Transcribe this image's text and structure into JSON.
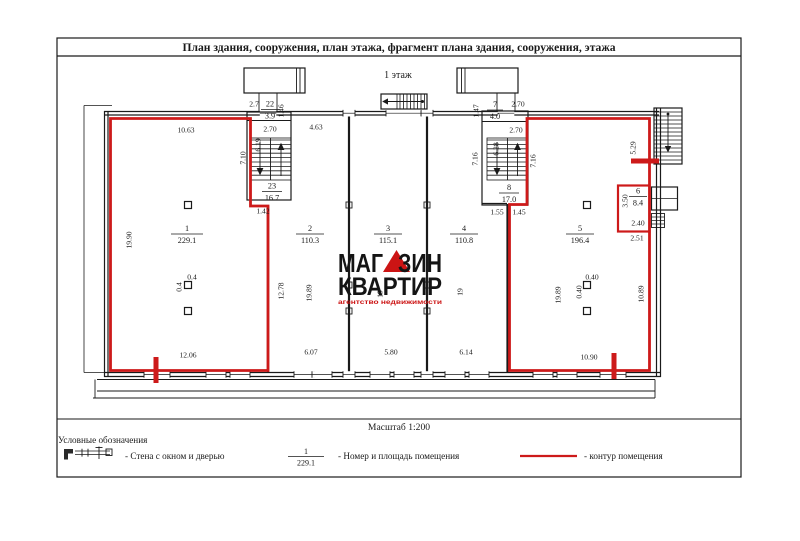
{
  "document": {
    "title": "План здания, сооружения, план этажа, фрагмент плана здания, сооружения, этажа",
    "floor_label": "1 этаж",
    "scale_label": "Масштаб 1:200"
  },
  "legend": {
    "heading": "Условные обозначения",
    "wall_item": "- Стена с окном и дверью",
    "number_item": "- Номер и площадь помещения",
    "contour_item": "- контур помещения",
    "example_number": "1",
    "example_area": "229.1"
  },
  "logo": {
    "word1_left": "МАГ",
    "word1_right": "ЗИН",
    "word2": "КВАРТИР",
    "tagline": "агентство недвижимости",
    "accent_color": "#cc1414"
  },
  "colors": {
    "contour_red": "#cd1a1a",
    "ink": "#1a1a1a"
  },
  "rooms": [
    {
      "number": "1",
      "area": "229.1"
    },
    {
      "number": "2",
      "area": "110.3"
    },
    {
      "number": "3",
      "area": "115.1"
    },
    {
      "number": "4",
      "area": "110.8"
    },
    {
      "number": "5",
      "area": "196.4"
    },
    {
      "number": "6",
      "area": "8.4"
    },
    {
      "number": "7",
      "area": "4.0"
    },
    {
      "number": "8",
      "area": "17.0"
    },
    {
      "number": "22",
      "area": "3.9"
    },
    {
      "number": "23",
      "area": "16.7"
    }
  ],
  "dims": [
    "10.63",
    "4.63",
    "2.7",
    "1.46",
    "2.70",
    "6.19",
    "7.10",
    "1.42",
    "19.90",
    "12.78",
    "19.89",
    "19",
    "19",
    "12.06",
    "6.07",
    "5.80",
    "6.14",
    "1.47",
    "2.70",
    "2.70",
    "6.28",
    "7.16",
    "7.16",
    "1.55",
    "1.45",
    "19.89",
    "10.89",
    "10.90",
    "3.50",
    "2.40",
    "2.51",
    "5.29",
    "0.4",
    "0.4",
    "0.40",
    "0.40"
  ]
}
